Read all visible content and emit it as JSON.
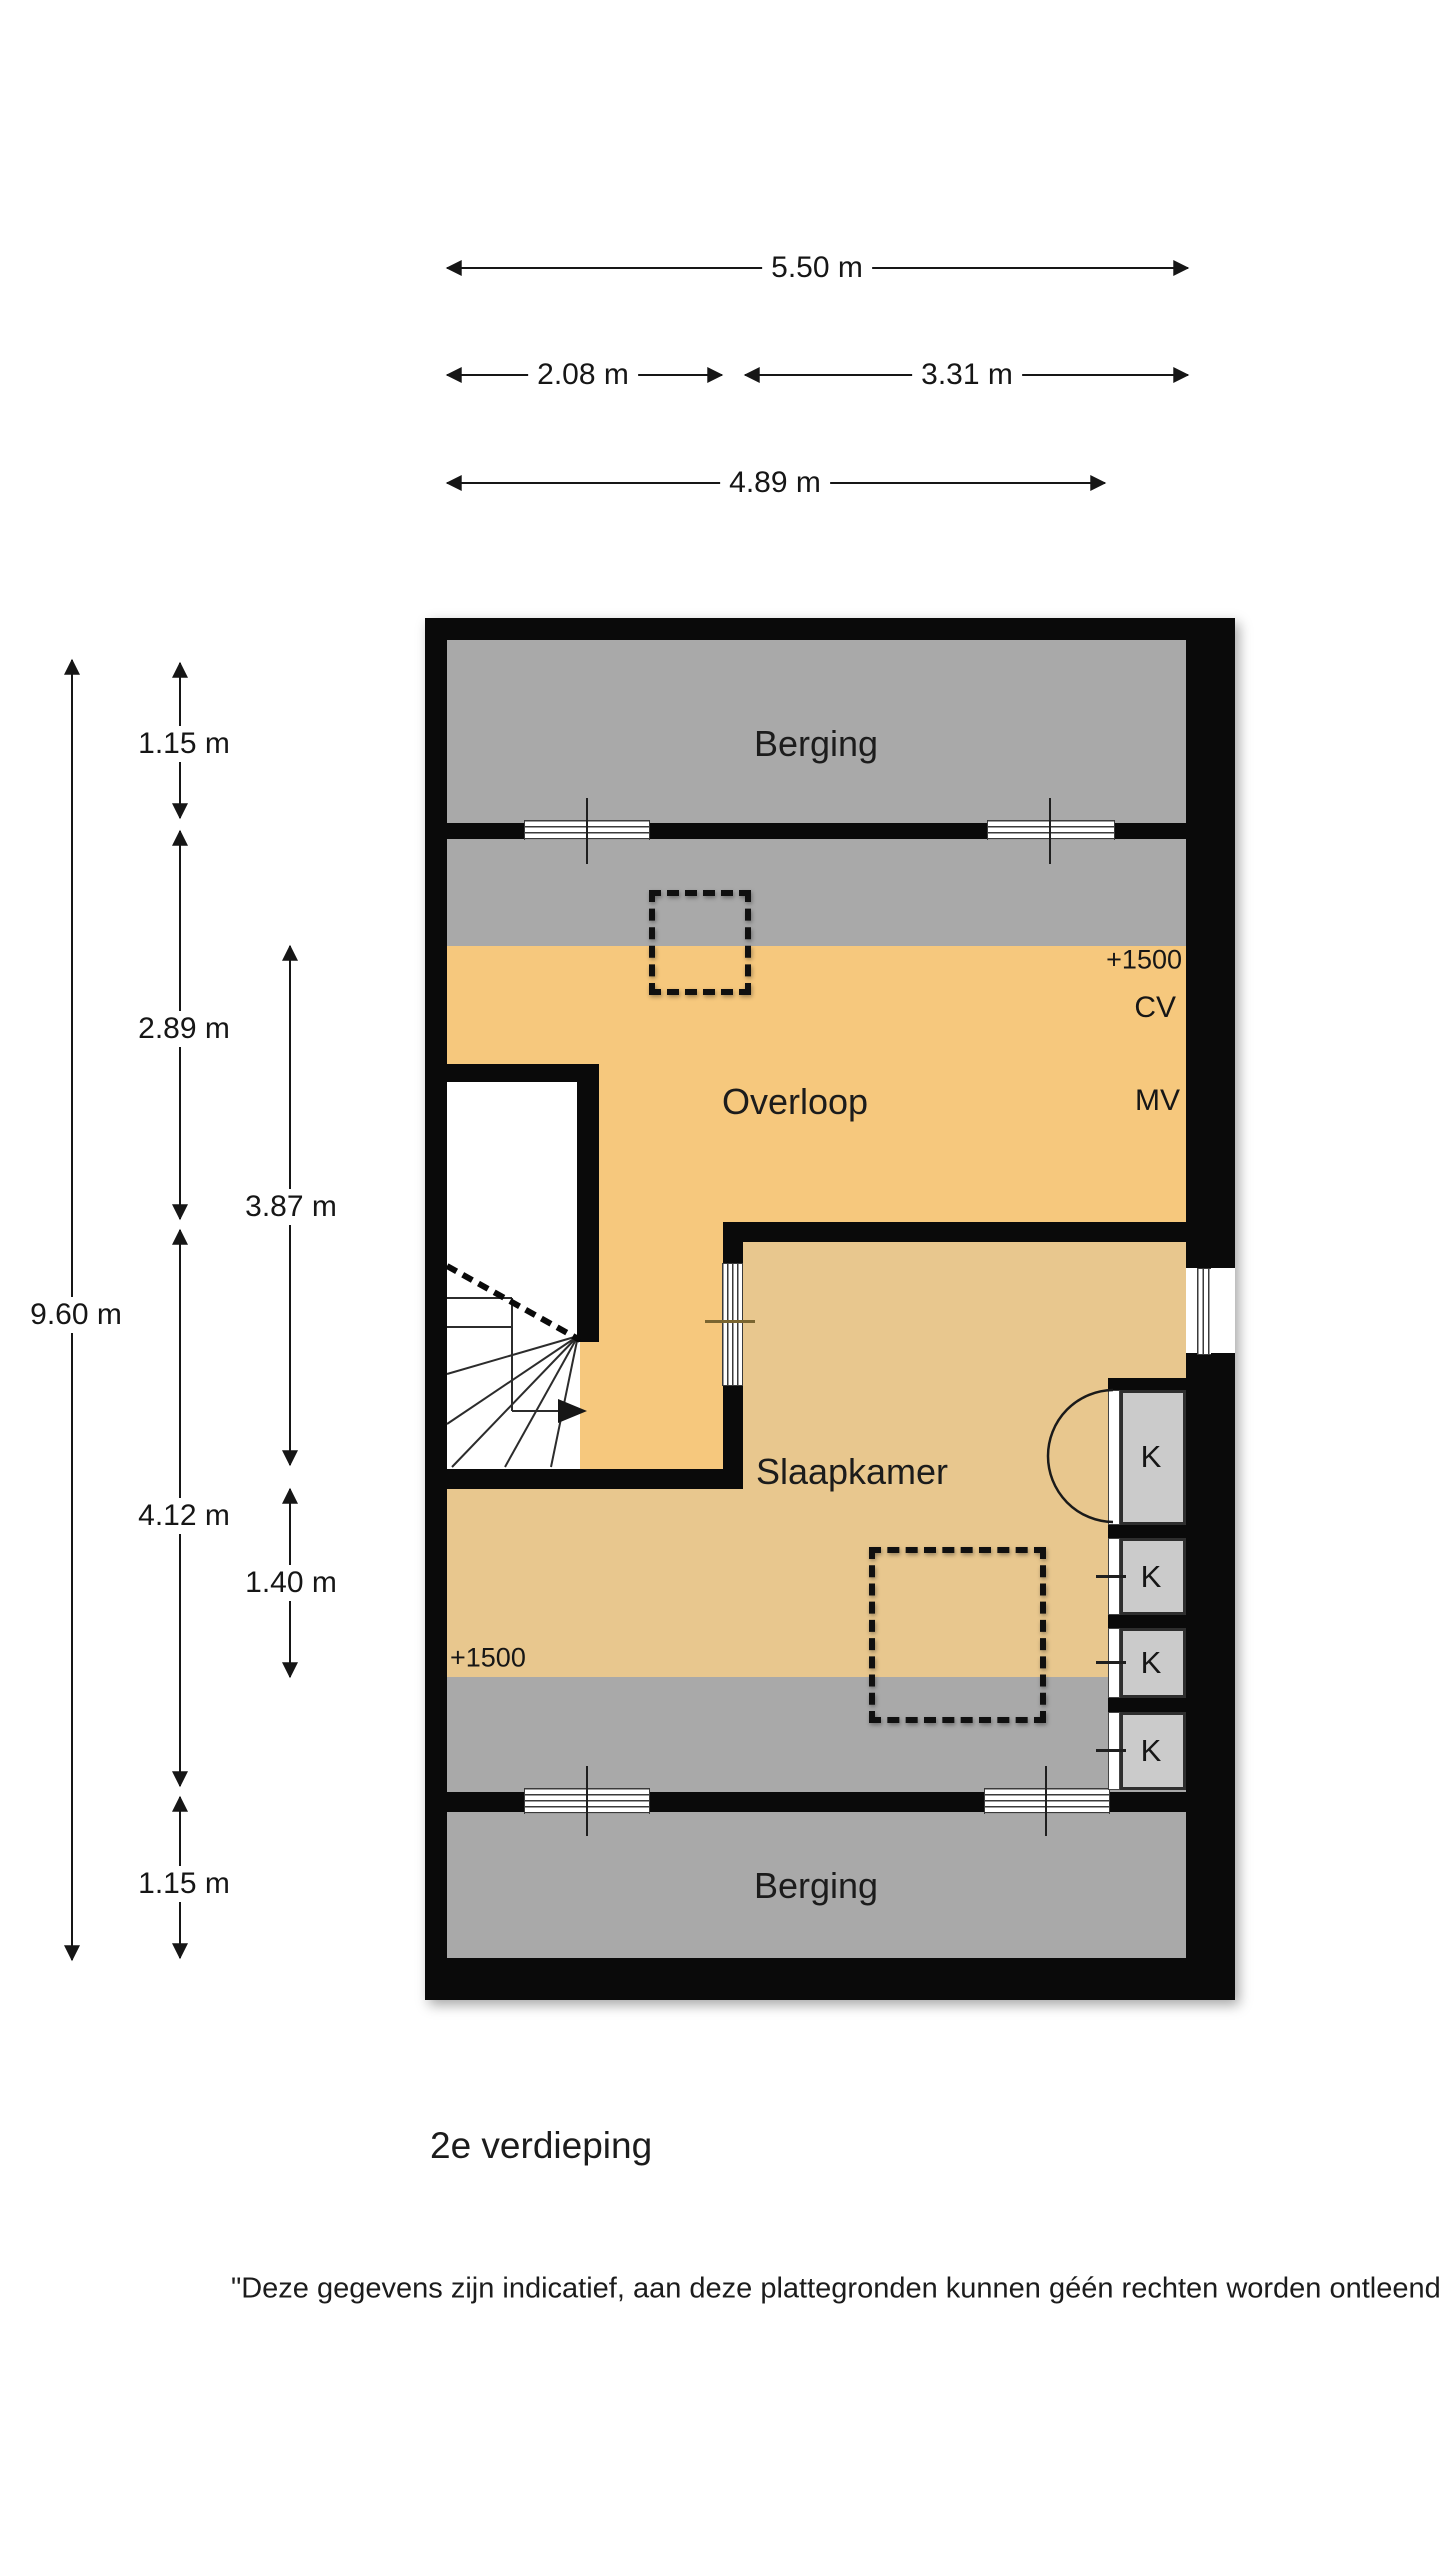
{
  "floor_plan": {
    "title": "2e verdieping",
    "disclaimer": "\"Deze gegevens zijn indicatief, aan deze plattegronden kunnen géén rechten worden ontleend\"",
    "rooms": {
      "berging_top": "Berging",
      "overloop": "Overloop",
      "slaapkamer": "Slaapkamer",
      "berging_bottom": "Berging"
    },
    "annotations": {
      "height_marker_top": "+1500",
      "height_marker_bottom": "+1500",
      "cv_unit": "CV",
      "mv_unit": "MV",
      "closets": [
        "K",
        "K",
        "K",
        "K"
      ]
    },
    "dimensions": {
      "width_total": "5.50 m",
      "width_left": "2.08 m",
      "width_right": "3.31 m",
      "width_room": "4.89 m",
      "height_total": "9.60 m",
      "height_berging_top": "1.15 m",
      "height_overloop": "2.89 m",
      "height_slaapkamer": "4.12 m",
      "height_berging_bottom": "1.15 m",
      "height_overloop_inner": "3.87 m",
      "height_slaapkamer_inner": "1.40 m"
    },
    "colors": {
      "room_orange": "#F6C87D",
      "room_tan": "#E8C78E",
      "room_gray": "#A9A9A9",
      "closet_gray": "#CBCBCB",
      "wall_black": "#0A0A0A",
      "door_line_brown": "#7A6530"
    }
  }
}
